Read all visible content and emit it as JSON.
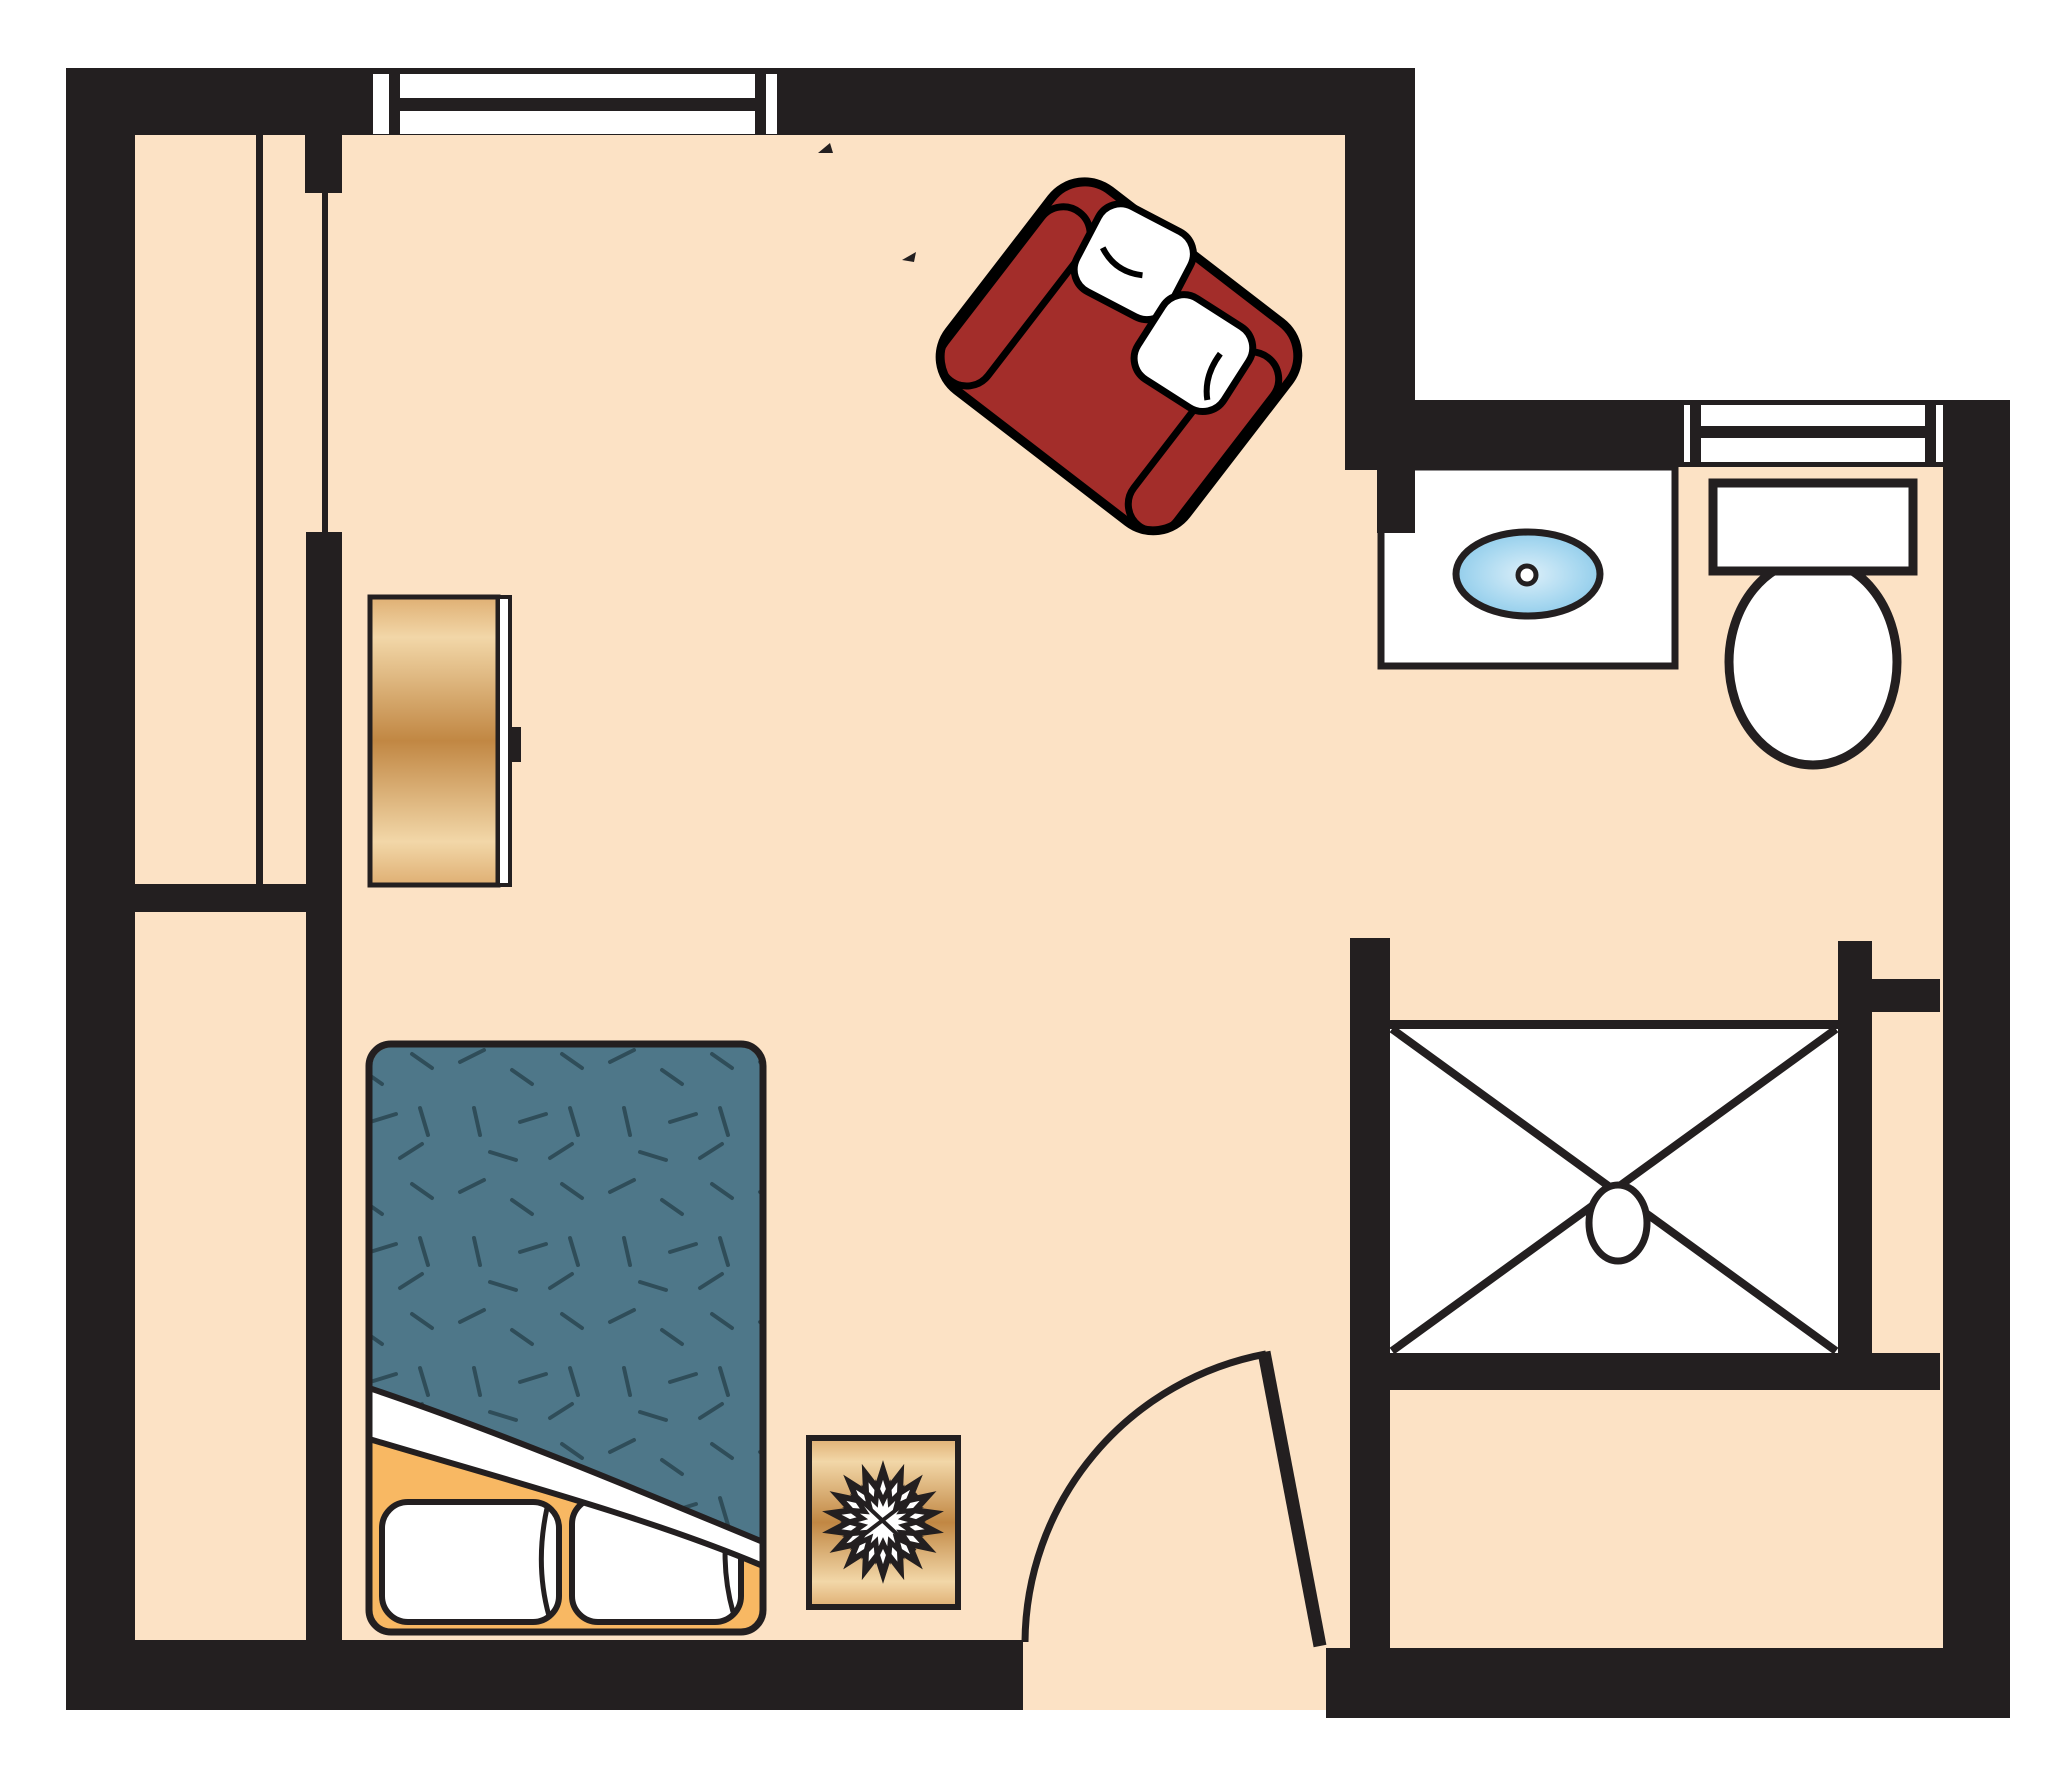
{
  "palette": {
    "wall": "#231F20",
    "line": "#231F20",
    "floor": "#FCE2C5",
    "white": "#FFFFFF",
    "sofa_red": "#A32D2A",
    "blanket_teal": "#4E7789",
    "blanket_dash": "#2F4D59",
    "mattress_orange": "#F8B863",
    "wood_light": "#F2D7A8",
    "wood_mid": "#DFAF73",
    "wood_dark": "#C18743",
    "sink_light": "#DCEFF9",
    "sink_mid": "#A8D8F0",
    "sink_deep": "#7FC3E6"
  },
  "diagram": {
    "type": "floor-plan",
    "rooms": [
      "main-room",
      "bathroom",
      "closet",
      "shower-room"
    ],
    "fixtures": [
      "top-window",
      "bathroom-window",
      "closet-partition",
      "dresser",
      "loveseat",
      "bed",
      "sunburst-side-table",
      "entry-door",
      "sink-vanity",
      "toilet",
      "shower-stall"
    ]
  }
}
